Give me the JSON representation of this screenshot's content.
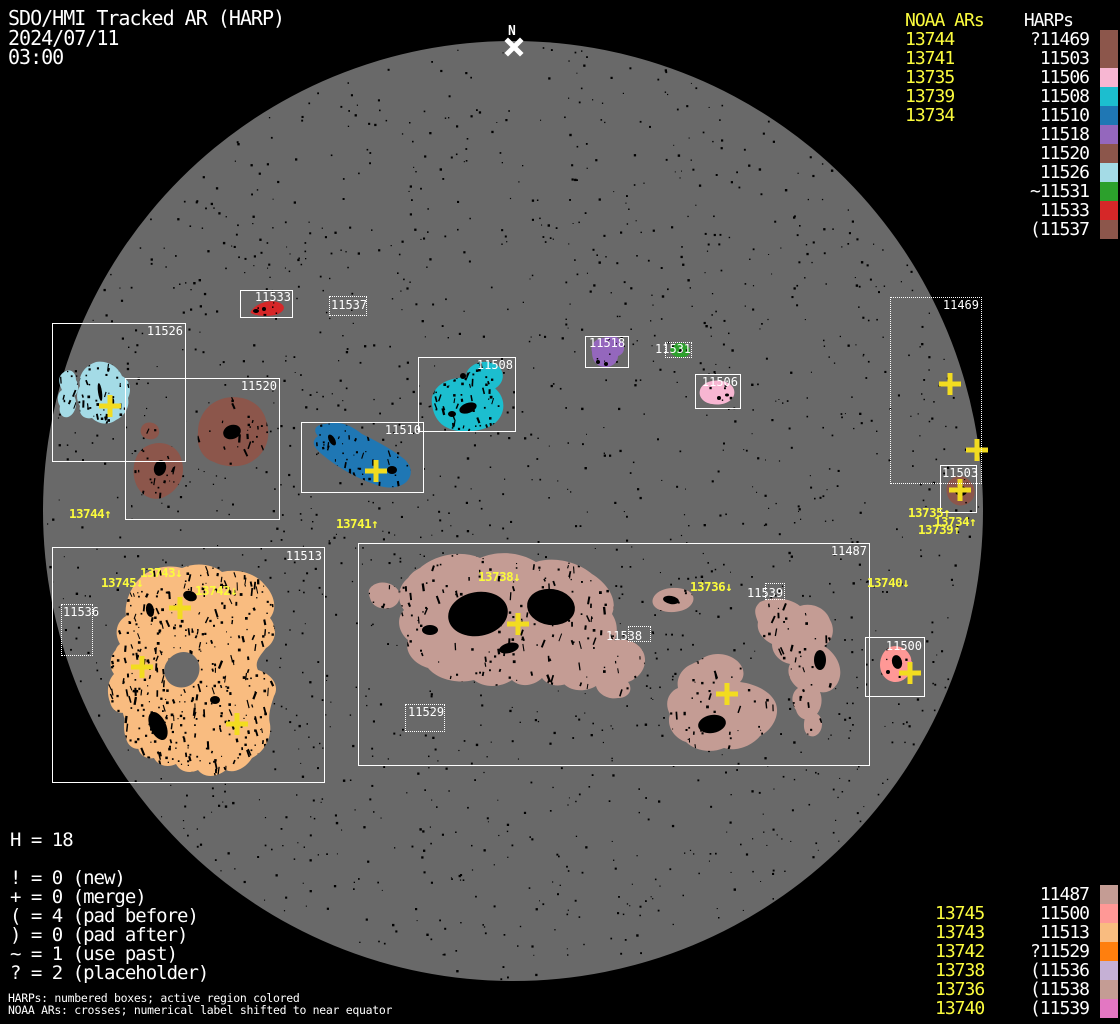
{
  "title": {
    "line1": "SDO/HMI Tracked AR (HARP)",
    "date": "2024/07/11",
    "time": "03:00"
  },
  "north_marker": "N",
  "colors": {
    "background": "#000000",
    "disk": "#696969",
    "box_line": "#FFFFFF",
    "noaa_text": "#FBFB3D",
    "cross": "#F2DC20",
    "harp_label": "#FFFFFF",
    "speckle": "#000000"
  },
  "harp_colors": {
    "11469": "#8C564B",
    "11487": "#C49C94",
    "11500": "#FF9896",
    "11503": "#8C564B",
    "11506": "#F7B6D2",
    "11508": "#1CBECF",
    "11510": "#1F77B4",
    "11513": "#F9BC80",
    "11518": "#9467BD",
    "11520": "#8C564B",
    "11526": "#A4DBE6",
    "11529": "#FF7F0E",
    "11531": "#2CA02C",
    "11533": "#D62728",
    "11536": "#C5B0D5",
    "11537": "#8C564B",
    "11538": "#C49C94",
    "11539": "#E377C2"
  },
  "legend_top": {
    "noaa_header": "NOAA ARs",
    "harp_header": "HARPs",
    "rows": [
      {
        "noaa": "13744",
        "harp": "?11469",
        "color": "#8C564B"
      },
      {
        "noaa": "13741",
        "harp": "11503",
        "color": "#8C564B"
      },
      {
        "noaa": "13735",
        "harp": "11506",
        "color": "#F7B6D2"
      },
      {
        "noaa": "13739",
        "harp": "11508",
        "color": "#1CBECF"
      },
      {
        "noaa": "13734",
        "harp": "11510",
        "color": "#1F77B4"
      },
      {
        "noaa": "",
        "harp": "11518",
        "color": "#9467BD"
      },
      {
        "noaa": "",
        "harp": "11520",
        "color": "#8C564B"
      },
      {
        "noaa": "",
        "harp": "11526",
        "color": "#A4DBE6"
      },
      {
        "noaa": "",
        "harp": "~11531",
        "color": "#2CA02C"
      },
      {
        "noaa": "",
        "harp": "11533",
        "color": "#D62728"
      },
      {
        "noaa": "",
        "harp": "(11537",
        "color": "#8C564B"
      }
    ]
  },
  "legend_bottom": {
    "rows": [
      {
        "noaa": "",
        "harp": "11487",
        "color": "#C49C94"
      },
      {
        "noaa": "13745",
        "harp": "11500",
        "color": "#FF9896"
      },
      {
        "noaa": "13743",
        "harp": "11513",
        "color": "#F9BC80"
      },
      {
        "noaa": "13742",
        "harp": "?11529",
        "color": "#FF7F0E"
      },
      {
        "noaa": "13738",
        "harp": "(11536",
        "color": "#C5B0D5"
      },
      {
        "noaa": "13736",
        "harp": "(11538",
        "color": "#C49C94"
      },
      {
        "noaa": "13740",
        "harp": "(11539",
        "color": "#E377C2"
      }
    ]
  },
  "stats": {
    "h_line": "H = 18",
    "lines": [
      "! = 0 (new)",
      "+ = 0 (merge)",
      "( = 4 (pad before)",
      ") = 0 (pad after)",
      "~ = 1 (use past)",
      "? = 2 (placeholder)"
    ]
  },
  "footnotes": [
    "HARPs: numbered boxes; active region colored",
    "NOAA ARs: crosses; numerical label shifted to near equator"
  ],
  "disk": {
    "boxes": [
      {
        "label": "11526"
      },
      {
        "label": "11520"
      },
      {
        "label": "11533"
      },
      {
        "label": "11537"
      },
      {
        "label": "11510"
      },
      {
        "label": "11508"
      },
      {
        "label": "11518"
      },
      {
        "label": "11531"
      },
      {
        "label": "11506"
      },
      {
        "label": "11469"
      },
      {
        "label": "11503"
      },
      {
        "label": "11513"
      },
      {
        "label": "11536"
      },
      {
        "label": "11487"
      },
      {
        "label": "11529"
      },
      {
        "label": "11500"
      },
      {
        "label": "11538"
      },
      {
        "label": "11539"
      }
    ],
    "noaa_labels": [
      {
        "text": "13744↑"
      },
      {
        "text": "13741↑"
      },
      {
        "text": "13745↓"
      },
      {
        "text": "13743↓"
      },
      {
        "text": "13742↓"
      },
      {
        "text": "13738↓"
      },
      {
        "text": "13736↓"
      },
      {
        "text": "13740↓"
      },
      {
        "text": "13735↑"
      },
      {
        "text": "13734↑"
      },
      {
        "text": "13739↑"
      }
    ]
  }
}
